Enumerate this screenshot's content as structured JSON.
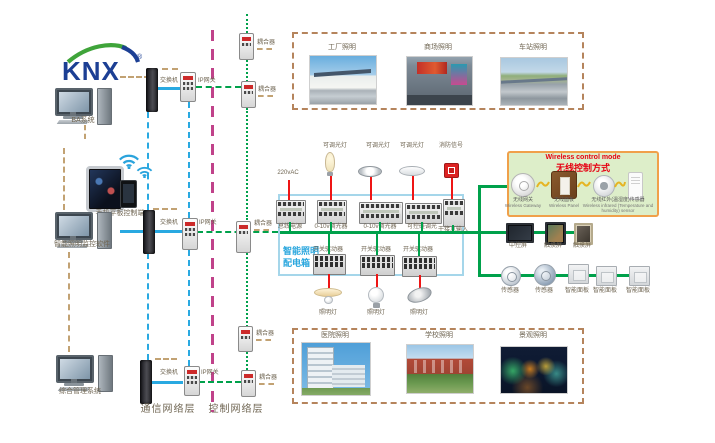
{
  "logo": {
    "text": "KNX",
    "reg": "®"
  },
  "left_devices": {
    "ba": "BA系统",
    "mobile": "手机平板控制端",
    "monitor_sw": "智能照明监控软件",
    "mgmt": "综合管理系统"
  },
  "network": {
    "switch": "交换机",
    "gateway": "IP网关",
    "coupler": "耦合器",
    "comm_layer": "通信网络层",
    "ctrl_layer": "控制网络层"
  },
  "applications": {
    "top": [
      "工厂照明",
      "商场照明",
      "车站照明"
    ],
    "bottom": [
      "医院照明",
      "学校照明",
      "景观照明"
    ]
  },
  "panel": {
    "name_line1": "智能照明",
    "name_line2": "配电箱",
    "power_input": "220vAC",
    "dimmable_lamp": "可调光灯",
    "fire_signal": "消防信号",
    "devices_top": [
      "总线电源",
      "0-10v调光器",
      "0-10v调光器",
      "可控硅调光",
      "干接点输入"
    ],
    "switch_actuator": "开关驱动器",
    "lamp": "照明灯"
  },
  "wireless": {
    "title_en": "Wireless control mode",
    "title_zh": "无线控制方式",
    "gateway_zh": "无线网关",
    "gateway_en": "Wireless Gateway",
    "panel_zh": "无线面板",
    "panel_en": "Wireless Panel",
    "sensor_zh": "无线红外(温湿度)传感器",
    "sensor_en1": "Wireless infrared (Temperature and",
    "sensor_en2": "humidity) sensor"
  },
  "right_devices": {
    "central_screen": "中控屏",
    "touch_screen": "触摸屏",
    "sensor": "传感器",
    "smart_panel": "智能面板"
  },
  "colors": {
    "bus_blue": "#29a9e1",
    "bus_green": "#00a14b",
    "backbone_magenta": "#c0428a",
    "link_tan": "#c2a273",
    "load_red": "#ee1515",
    "panel_border": "#a5d6ea",
    "panel_text": "#2ba7de",
    "wireless_bg": "#ddeec9",
    "wireless_border": "#f0a04a",
    "wireless_title": "#e60012",
    "knx_blue": "#1c3f94",
    "knx_green": "#3fa43a"
  }
}
